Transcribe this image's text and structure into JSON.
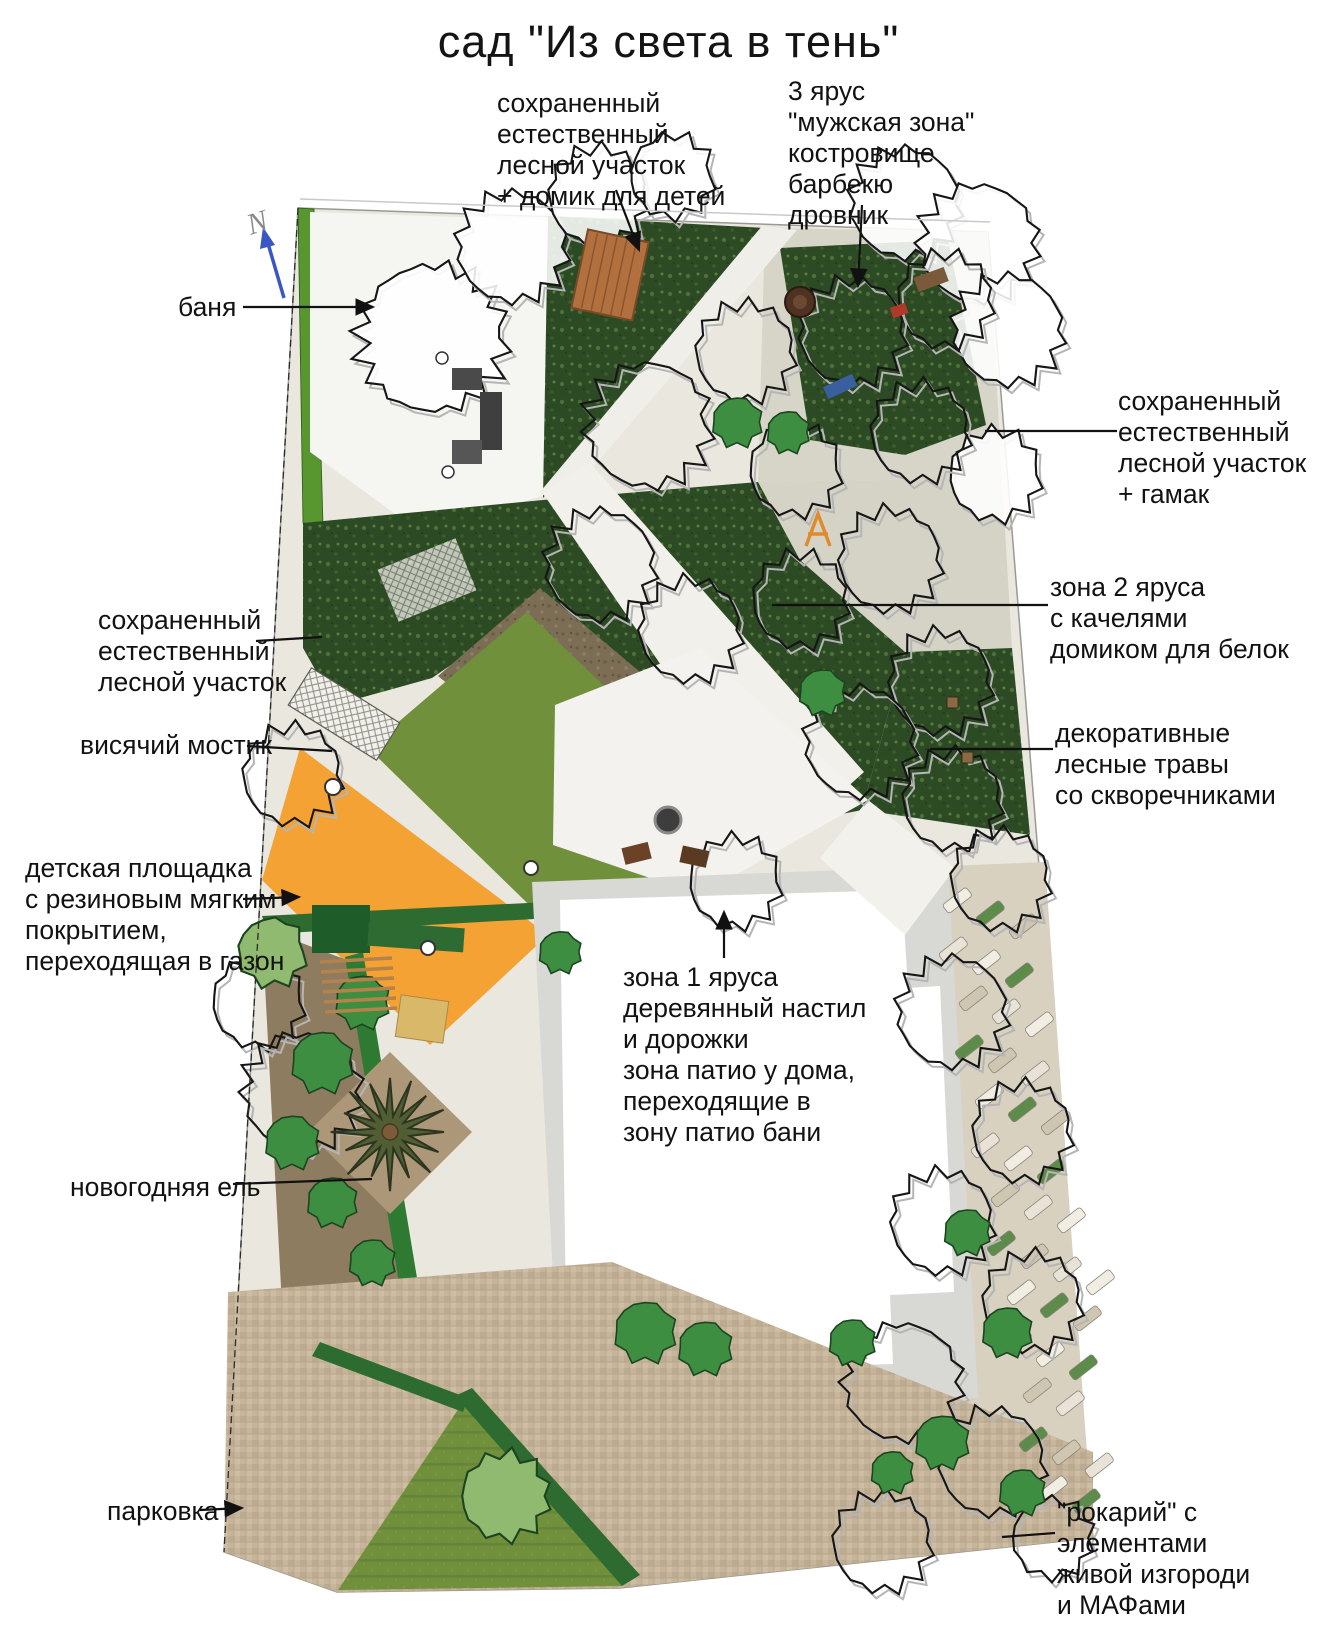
{
  "title": "сад \"Из света в тень\"",
  "compass": {
    "letter": "N"
  },
  "labels": {
    "preserved_forest_kids": {
      "text": "сохраненный\nестественный\nлесной участок\n+ домик для детей"
    },
    "tier3_male_zone": {
      "text": "3 ярус\n\"мужская зона\"\nкостровище\nбарбекю\nдровник"
    },
    "banya": {
      "text": "баня"
    },
    "preserved_forest_hammock": {
      "text": "сохраненный\nестественный\nлесной участок\n+ гамак"
    },
    "tier2_swings": {
      "text": "зона 2 яруса\nс качелями\nдомиком для белок"
    },
    "decorative_grasses": {
      "text": "декоративные\nлесные травы\nсо скворечниками"
    },
    "preserved_forest_left": {
      "text": "сохраненный\nестественный\nлесной участок"
    },
    "hanging_bridge": {
      "text": "висячий мостик"
    },
    "playground": {
      "text": "детская площадка\nс резиновым мягким\nпокрытием,\nпереходящая в газон"
    },
    "tier1_deck": {
      "text": "зона 1 яруса\nдеревянный настил\nи дорожки\nзона патио у дома,\nпереходящие в\nзону патио бани"
    },
    "new_year_spruce": {
      "text": "новогодняя ель"
    },
    "parking": {
      "text": "парковка"
    },
    "rockery": {
      "text": "\"рокарий\" с элементами\nживой изгороди\nи МАФами"
    }
  },
  "colors": {
    "playground": "#f4a233",
    "lawn": "#71903c",
    "forest": "#2c4a24",
    "paving_light": "#f3f2ee",
    "parking": "#c6b59a",
    "compass_arrow": "#3a56c4"
  }
}
